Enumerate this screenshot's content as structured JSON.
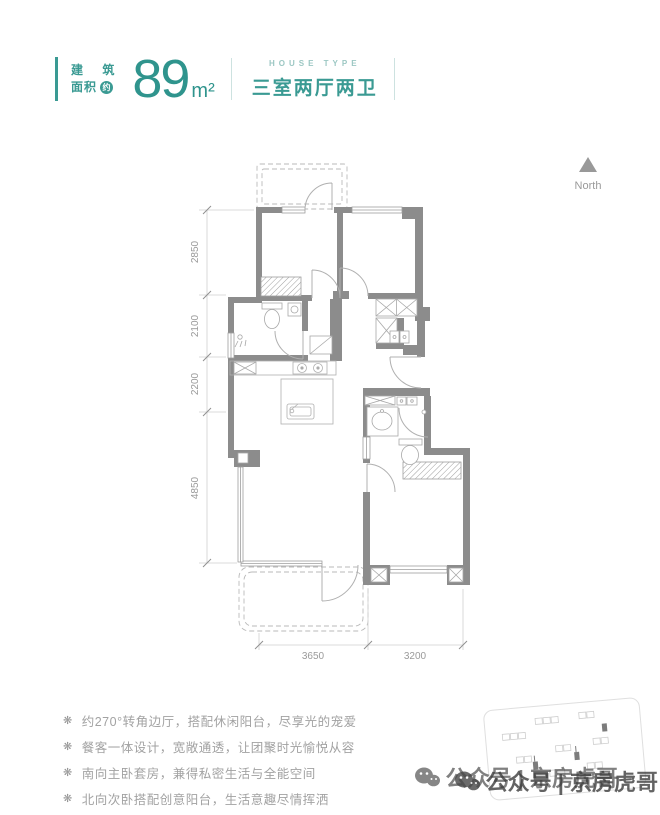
{
  "colors": {
    "accent": "#3a9a93",
    "accent_light": "#9cc7c3",
    "wall_gray": "#8c8c8c"
  },
  "header": {
    "area_label_top": "建 筑",
    "area_label_bottom": "面积",
    "area_badge": "约",
    "area_value": "89",
    "area_unit": "m²",
    "house_type_en": "HOUSE TYPE",
    "house_type_cn": "三室两厅两卫"
  },
  "compass": {
    "label": "North",
    "icon": "north-triangle-icon"
  },
  "floorplan": {
    "left_dims": [
      "2850",
      "2100",
      "2200",
      "4850"
    ],
    "bottom_dims": [
      "3650",
      "3200"
    ]
  },
  "features": {
    "bullet_icon": "❋",
    "items": [
      "约270°转角边厅，搭配休闲阳台，尽享光的宠爱",
      "餐客一体设计，宽敞通透，让团聚时光愉悦从容",
      "南向主卧套房，兼得私密生活与全能空间",
      "北向次卧搭配创意阳台，生活意趣尽情挥洒"
    ]
  },
  "watermark": {
    "icon": "wechat-icon",
    "text": "公众号 | 京房虎哥"
  }
}
